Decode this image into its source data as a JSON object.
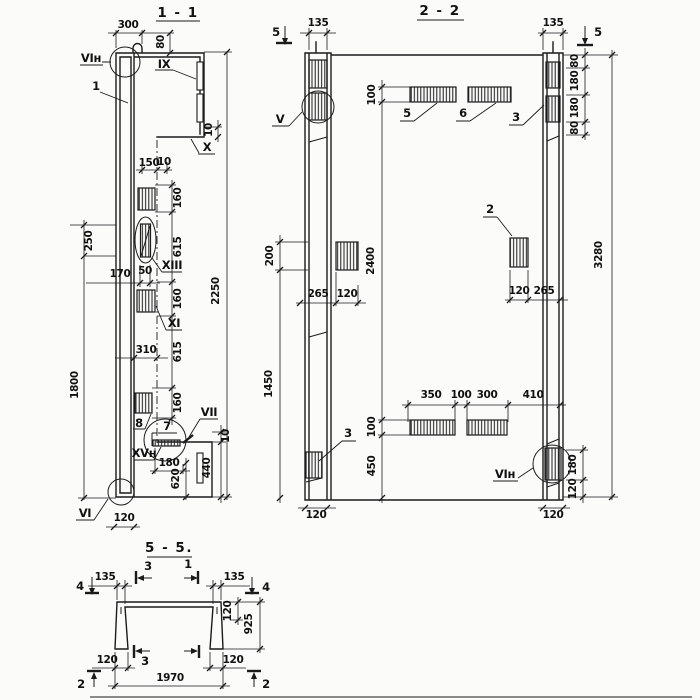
{
  "s1": {
    "title": "1 - 1",
    "labels": {
      "vin": "VIн",
      "one": "1",
      "ix": "IX",
      "x": "X",
      "xiii": "XIII",
      "xi": "XI",
      "eight": "8",
      "seven": "7",
      "vii": "VII",
      "xvn": "XVн",
      "vi": "VI"
    },
    "dims": {
      "a300": "300",
      "a80": "80",
      "a150": "150",
      "a10t": "10",
      "a160a": "160",
      "a615a": "615",
      "a160b": "160",
      "a615b": "615",
      "a160c": "160",
      "a2250": "2250",
      "a250": "250",
      "a1800": "1800",
      "a170": "170",
      "a50": "50",
      "a310": "310",
      "a10x": "10",
      "a10f": "10",
      "a180": "180",
      "a620": "620",
      "a440": "440",
      "a120": "120"
    }
  },
  "s2": {
    "title": "2 - 2",
    "labels": {
      "v": "V",
      "five": "5",
      "six": "6",
      "three_t": "3",
      "two": "2",
      "three_b": "3",
      "vin": "VIн"
    },
    "markers": {
      "five_l": "5",
      "five_r": "5"
    },
    "dims": {
      "b135l": "135",
      "b135r": "135",
      "b100t": "100",
      "b80a": "80",
      "b180a": "180",
      "b180b": "180",
      "b80b": "80",
      "b3280": "3280",
      "b2400": "2400",
      "b200": "200",
      "b265l": "265",
      "b120l": "120",
      "b120r": "120",
      "b265r": "265",
      "b350": "350",
      "b100m": "100",
      "b300": "300",
      "b410": "410",
      "b100b": "100",
      "b450": "450",
      "b1450": "1450",
      "b180r": "180",
      "b120rb": "120",
      "b120bl": "120",
      "b120br": "120"
    }
  },
  "s5": {
    "title": "5 - 5.",
    "markers": {
      "four_l": "4",
      "four_r": "4",
      "two_l": "2",
      "two_r": "2",
      "three_t": "3",
      "one_t": "1",
      "three_b": "3"
    },
    "dims": {
      "c135l": "135",
      "c135r": "135",
      "c120s": "120",
      "c925": "925",
      "c120bl": "120",
      "c1970": "1970",
      "c120br": "120"
    }
  }
}
